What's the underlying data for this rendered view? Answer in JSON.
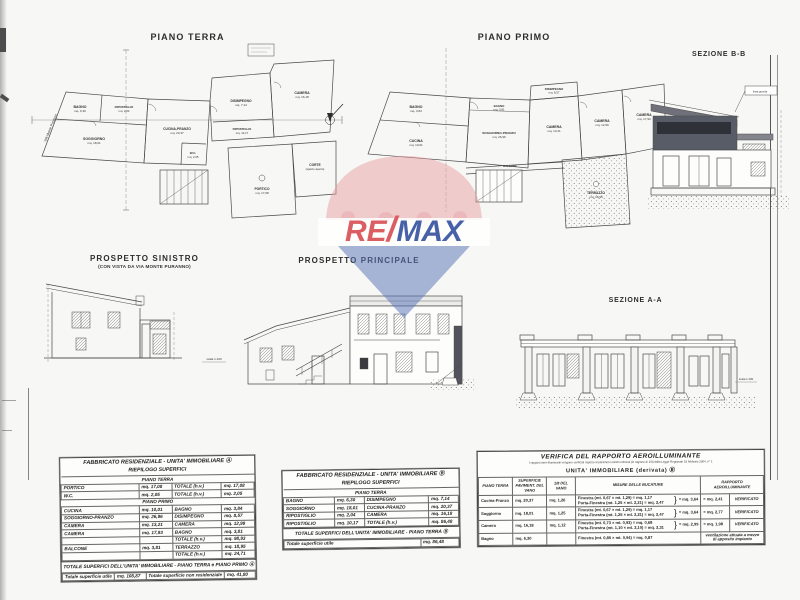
{
  "page": {
    "background": "#f7f7f5"
  },
  "watermark": {
    "re": "RE",
    "slash": "/",
    "max": "MAX",
    "red": "#d8494f",
    "blue": "#2f4d9e",
    "pink": "#e59aa0",
    "cone_blue": "#5b76b9"
  },
  "panels": {
    "piano_terra": {
      "title": "PIANO TERRA",
      "street": "VIA Monte Puranno",
      "rooms": [
        {
          "name": "BAGNO",
          "area": "mq. 6,30"
        },
        {
          "name": "SOGGIORNO",
          "area": "mq. 18,01"
        },
        {
          "name": "RIPOSTIGLIO",
          "area": "mq. 2,04"
        },
        {
          "name": "CUCINA-PRANZO",
          "area": "mq. 20,37"
        },
        {
          "name": "DISIMPEGNO",
          "area": "mq. 7,14"
        },
        {
          "name": "CAMERA",
          "area": "mq. 16,18"
        },
        {
          "name": "W.C.",
          "area": "mq. 2,05"
        },
        {
          "name": "RIPOSTIGLIO",
          "area": "mq. 10,17"
        },
        {
          "name": "PORTICO",
          "area": "mq. 17,08"
        },
        {
          "name": "CORTE",
          "area": "(spazio aperto)"
        }
      ]
    },
    "piano_primo": {
      "title": "PIANO PRIMO",
      "rooms": [
        {
          "name": "BAGNO",
          "area": "mq. 3,84"
        },
        {
          "name": "CUCINA",
          "area": "mq. 10,01"
        },
        {
          "name": "SOGGIORNO-PRANZO",
          "area": "mq. 26,96"
        },
        {
          "name": "DISIMPEGNO",
          "area": "mq. 8,57"
        },
        {
          "name": "CAMERA",
          "area": "mq. 13,21"
        },
        {
          "name": "CAMERA",
          "area": "mq. 12,99"
        },
        {
          "name": "CAMERA",
          "area": "mq. 17,93"
        },
        {
          "name": "BAGNO",
          "area": "mq. 3,81"
        },
        {
          "name": "TERRAZZO",
          "area": "mq. 18,95"
        },
        {
          "name": "BALCONE",
          "area": "mq. 3,81"
        }
      ]
    },
    "sezione_bb": {
      "title": "SEZIONE B-B",
      "note_line1": "porzione di edificio non oggetto",
      "note_line2": "dell'intervento edilizio",
      "tag": "linea gronda"
    },
    "prospetto_sinistro": {
      "title": "PROSPETTO SINISTRO",
      "subtitle": "(CON VISTA DA VIA MONTE PURANNO)",
      "scale_note": "scala 1:100"
    },
    "prospetto_principale": {
      "title": "PROSPETTO PRINCIPALE"
    },
    "sezione_aa": {
      "title": "SEZIONE A-A",
      "scale_note": "scala 1:100"
    }
  },
  "tables": {
    "unitA": {
      "title_line1": "FABBRICATO RESIDENZIALE - UNITA' IMMOBILIARE Ⓐ",
      "title_line2": "RIEPILOGO SUPERFICI",
      "section1": "PIANO TERRA",
      "section2": "PIANO PRIMO",
      "rows_pt": [
        [
          "PORTICO",
          "mq. 17,08",
          "TOTALE (h.v.)",
          "mq. 17,08"
        ],
        [
          "W.C.",
          "mq. 2,05",
          "TOTALE (h.v.)",
          "mq. 2,05"
        ]
      ],
      "rows_pp": [
        [
          "CUCINA",
          "mq. 10,01",
          "BAGNO",
          "mq. 3,84"
        ],
        [
          "SOGGIORNO-PRANZO",
          "mq. 26,96",
          "DISIMPEGNO",
          "mq. 8,57"
        ],
        [
          "CAMERA",
          "mq. 13,21",
          "CAMERA",
          "mq. 12,99"
        ],
        [
          "CAMERA",
          "mq. 17,93",
          "BAGNO",
          "mq. 3,81"
        ],
        [
          "",
          "",
          "TOTALE (h.v.)",
          "mq. 98,93"
        ],
        [
          "BALCONE",
          "mq. 3,81",
          "TERRAZZO",
          "mq. 18,95"
        ],
        [
          "",
          "",
          "TOTALE (h.v.)",
          "mq. 24,71"
        ]
      ],
      "footer_band": "TOTALE SUPERFICI DELL'UNITA' IMMOBILIARE - PIANO TERRA e PIANO PRIMO Ⓐ",
      "footer_row": [
        "Totale superficie utile",
        "mq. 108,87",
        "Totale superficie non residenziale",
        "mq. 41,80"
      ]
    },
    "unitB": {
      "title_line1": "FABBRICATO RESIDENZIALE - UNITA' IMMOBILIARE Ⓑ",
      "title_line2": "RIEPILOGO SUPERFICI",
      "section1": "PIANO TERRA",
      "rows": [
        [
          "BAGNO",
          "mq. 6,30",
          "DISIMPEGNO",
          "mq. 7,14"
        ],
        [
          "SOGGIORNO",
          "mq. 18,01",
          "CUCINA-PRANZO",
          "mq. 20,37"
        ],
        [
          "RIPOSTIGLIO",
          "mq. 2,04",
          "CAMERA",
          "mq. 16,18"
        ],
        [
          "RIPOSTIGLIO",
          "mq. 10,17",
          "TOTALE (h.v.)",
          "mq. 86,48"
        ]
      ],
      "footer_band": "TOTALE SUPERFICI DELL'UNITA' IMMOBILIARE - PIANO TERRA Ⓑ",
      "footer_row": [
        "Totale superficie utile",
        "mq. 86,48"
      ]
    },
    "verifica": {
      "title": "VERIFICA DEL RAPPORTO AEROILLUMINANTE",
      "subtitle": "I rapporti aero-illuminanti vengono verificati rispetto ai parametri minimi richiesti (in ragione di 1/8) dalla Legge Regionale 18 febbraio 2004, n° 1",
      "unit_line": "UNITA' IMMOBILIARE (derivata) Ⓑ",
      "headers": [
        "PIANO TERRA",
        "SUPERFICIE PAVIMENT. DEL VANO",
        "1/8 DEL VANO",
        "MISURE DELLE BUCATURE",
        "RAPPORTO AEROILLUMINANTE"
      ],
      "rows": [
        {
          "vano": "Cucina-Pranzo",
          "sup": "mq. 20,37",
          "ottavo": "mq. 1,26",
          "f1": "Finestra  (mt. 0,67 × mt. 1,29) = mq. 1,17",
          "f2": "Porta-Finestra  (mt. 1,25 × mt. 2,21) = mq. 2,47",
          "tot": "= mq. 3,64",
          "rap": "= mq. 2,41",
          "esito": "VERIFICATO"
        },
        {
          "vano": "Soggiorno",
          "sup": "mq. 18,01",
          "ottavo": "mq. 1,25",
          "f1": "Finestra  (mt. 0,67 × mt. 1,29) = mq. 1,17",
          "f2": "Porta-Finestra  (mt. 1,25 × mt. 2,21) = mq. 2,47",
          "tot": "= mq. 3,64",
          "rap": "= mq. 2,77",
          "esito": "VERIFICATO"
        },
        {
          "vano": "Camera",
          "sup": "mq. 16,18",
          "ottavo": "mq. 1,12",
          "f1": "Finestra  (mt. 0,73 × mt. 0,93) = mq. 0,68",
          "f2": "Porta-Finestra  (mt. 1,10 × mt. 2,10) = mq. 2,31",
          "tot": "= mq. 2,99",
          "rap": "= mq. 1,98",
          "esito": "VERIFICATO"
        },
        {
          "vano": "Bagno",
          "sup": "mq. 6,30",
          "f1": "Finestra  (mt. 0,85 × mt. 0,94) = mq. 0,87",
          "esito": "ventilazione attuata a mezzo di apposito impianto"
        }
      ]
    }
  }
}
